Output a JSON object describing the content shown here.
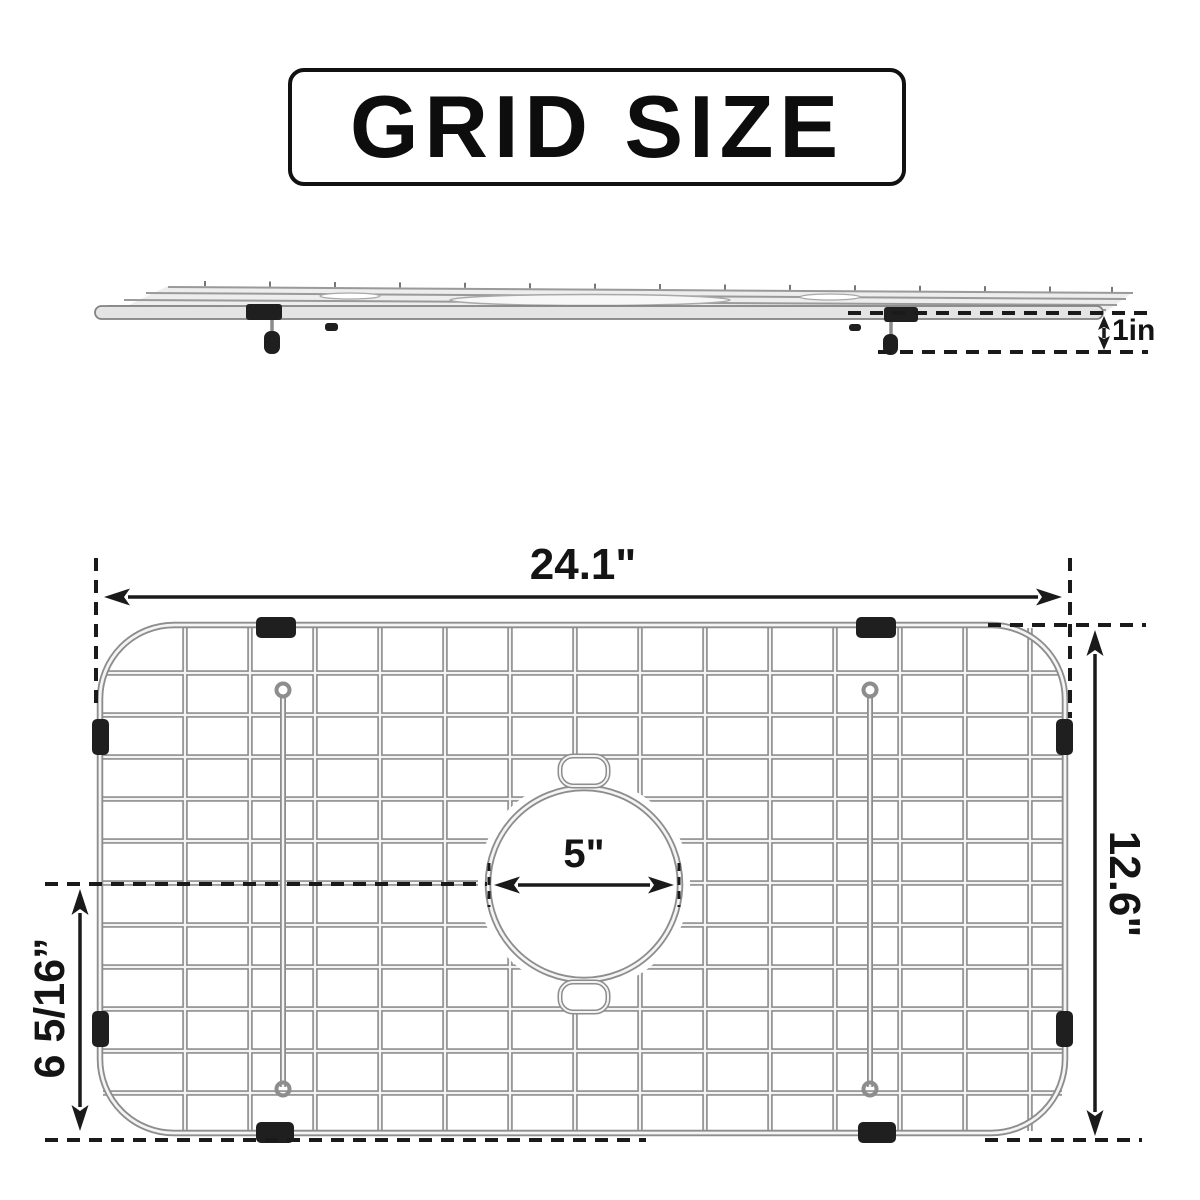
{
  "title": {
    "label": "GRID SIZE"
  },
  "dimensions": {
    "overall_width": "24.1\"",
    "overall_depth": "12.6\"",
    "drain_offset": "6 5/16”",
    "hole_diameter": "5\"",
    "grid_height": "1in"
  },
  "colors": {
    "line": "#1a1a1a",
    "wire_edge": "#8d8d8d",
    "wire_core": "#f4f4f4",
    "rubber_pad": "#1f1f1f",
    "background": "#ffffff"
  }
}
